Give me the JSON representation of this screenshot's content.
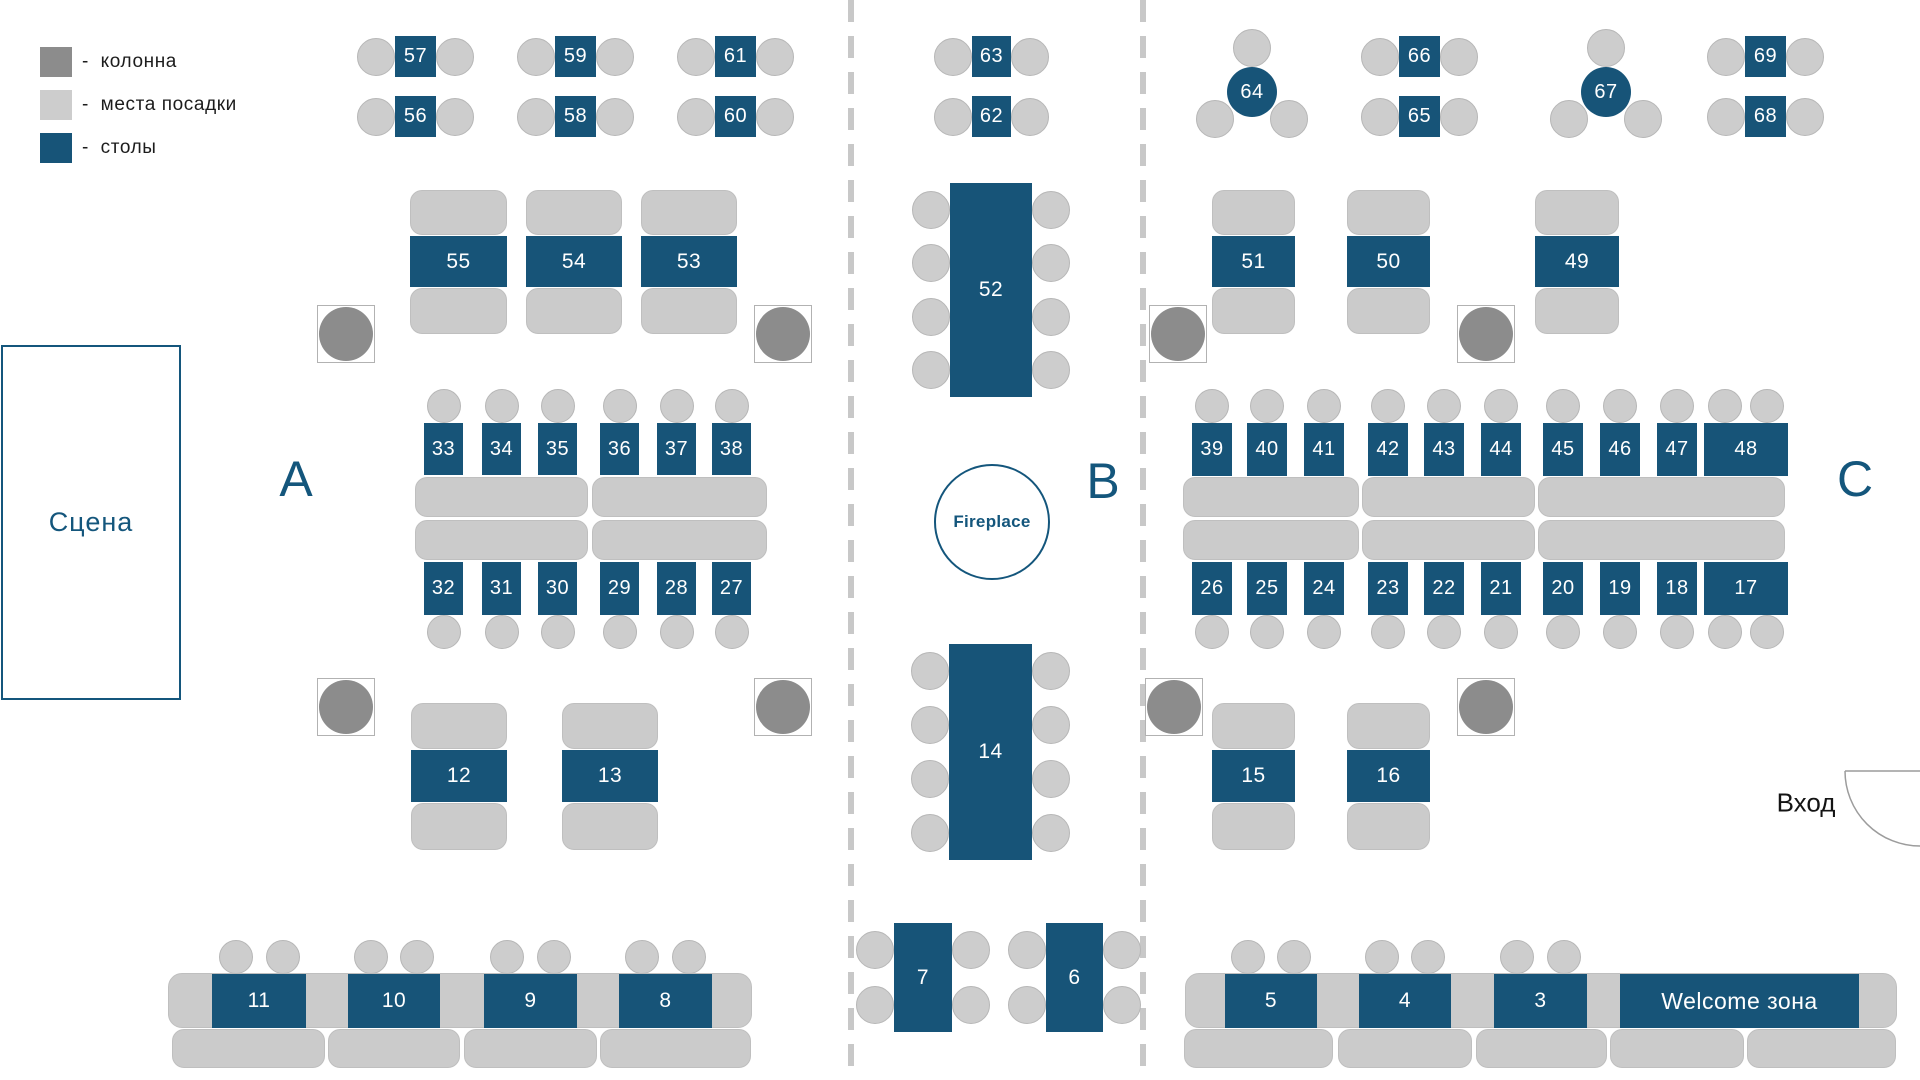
{
  "canvas": {
    "w": 1920,
    "h": 1080
  },
  "colors": {
    "table": "#175478",
    "table_text": "#FFFFFF",
    "seat": "#CDCDCD",
    "seat_stroke": "#B7B7B7",
    "bench": "#CBCBCB",
    "bench_stroke": "#BFBFBF",
    "column": "#8C8C8C",
    "column_box_stroke": "#B2B2B2",
    "divider": "#C8C8C8",
    "blue_text": "#14567C",
    "dark_text": "#1C1C1C",
    "door": "#9C9C9C"
  },
  "legend": {
    "items": [
      {
        "type": "column",
        "label": "-  колонна"
      },
      {
        "type": "seat",
        "label": "-  места посадки"
      },
      {
        "type": "table",
        "label": "-  столы"
      }
    ]
  },
  "labels": {
    "stage": "Сцена",
    "sections": [
      {
        "text": "А",
        "x": 296,
        "y": 479
      },
      {
        "text": "В",
        "x": 1103,
        "y": 481
      },
      {
        "text": "С",
        "x": 1855,
        "y": 479
      }
    ],
    "fireplace": {
      "text": "Fireplace",
      "cx": 992,
      "cy": 522,
      "r": 58
    },
    "entrance": {
      "text": "Вход",
      "x": 1806,
      "y": 803
    }
  },
  "stage": {
    "x": 1,
    "y": 345,
    "w": 180,
    "h": 355
  },
  "door": {
    "wall": "M1845 771 L1920 771",
    "arc": "M1845 771 A75 75 0 0 0 1920 846"
  },
  "dividers": [
    {
      "x": 848
    },
    {
      "x": 1140
    }
  ],
  "columns": [
    {
      "cx": 346,
      "cy": 334
    },
    {
      "cx": 783,
      "cy": 334
    },
    {
      "cx": 1178,
      "cy": 334
    },
    {
      "cx": 1486,
      "cy": 334
    },
    {
      "cx": 346,
      "cy": 707
    },
    {
      "cx": 783,
      "cy": 707
    },
    {
      "cx": 1174,
      "cy": 707
    },
    {
      "cx": 1486,
      "cy": 707
    }
  ],
  "benches": [
    {
      "x": 410,
      "y": 190,
      "w": 97,
      "h": 45
    },
    {
      "x": 526,
      "y": 190,
      "w": 96,
      "h": 45
    },
    {
      "x": 641,
      "y": 190,
      "w": 96,
      "h": 45
    },
    {
      "x": 410,
      "y": 288,
      "w": 97,
      "h": 46
    },
    {
      "x": 526,
      "y": 288,
      "w": 96,
      "h": 46
    },
    {
      "x": 641,
      "y": 288,
      "w": 96,
      "h": 46
    },
    {
      "x": 1212,
      "y": 190,
      "w": 83,
      "h": 45
    },
    {
      "x": 1347,
      "y": 190,
      "w": 83,
      "h": 45
    },
    {
      "x": 1535,
      "y": 190,
      "w": 84,
      "h": 45
    },
    {
      "x": 1212,
      "y": 288,
      "w": 83,
      "h": 46
    },
    {
      "x": 1347,
      "y": 288,
      "w": 83,
      "h": 46
    },
    {
      "x": 1535,
      "y": 288,
      "w": 84,
      "h": 46
    },
    {
      "x": 415,
      "y": 477,
      "w": 173,
      "h": 40
    },
    {
      "x": 592,
      "y": 477,
      "w": 175,
      "h": 40
    },
    {
      "x": 415,
      "y": 520,
      "w": 173,
      "h": 40
    },
    {
      "x": 592,
      "y": 520,
      "w": 175,
      "h": 40
    },
    {
      "x": 1183,
      "y": 477,
      "w": 176,
      "h": 40
    },
    {
      "x": 1362,
      "y": 477,
      "w": 173,
      "h": 40
    },
    {
      "x": 1538,
      "y": 477,
      "w": 247,
      "h": 40
    },
    {
      "x": 1183,
      "y": 520,
      "w": 176,
      "h": 40
    },
    {
      "x": 1362,
      "y": 520,
      "w": 173,
      "h": 40
    },
    {
      "x": 1538,
      "y": 520,
      "w": 247,
      "h": 40
    },
    {
      "x": 411,
      "y": 703,
      "w": 96,
      "h": 46
    },
    {
      "x": 562,
      "y": 703,
      "w": 96,
      "h": 46
    },
    {
      "x": 411,
      "y": 803,
      "w": 96,
      "h": 47
    },
    {
      "x": 562,
      "y": 803,
      "w": 96,
      "h": 47
    },
    {
      "x": 1212,
      "y": 703,
      "w": 83,
      "h": 46
    },
    {
      "x": 1347,
      "y": 703,
      "w": 83,
      "h": 46
    },
    {
      "x": 1212,
      "y": 803,
      "w": 83,
      "h": 47
    },
    {
      "x": 1347,
      "y": 803,
      "w": 83,
      "h": 47
    },
    {
      "x": 168,
      "y": 973,
      "w": 584,
      "h": 55,
      "rad": 14
    },
    {
      "x": 172,
      "y": 1029,
      "w": 153,
      "h": 39
    },
    {
      "x": 328,
      "y": 1029,
      "w": 132,
      "h": 39
    },
    {
      "x": 464,
      "y": 1029,
      "w": 133,
      "h": 39
    },
    {
      "x": 600,
      "y": 1029,
      "w": 151,
      "h": 39
    },
    {
      "x": 1185,
      "y": 973,
      "w": 712,
      "h": 55,
      "rad": 14
    },
    {
      "x": 1184,
      "y": 1029,
      "w": 149,
      "h": 39
    },
    {
      "x": 1338,
      "y": 1029,
      "w": 134,
      "h": 39
    },
    {
      "x": 1476,
      "y": 1029,
      "w": 131,
      "h": 39
    },
    {
      "x": 1610,
      "y": 1029,
      "w": 134,
      "h": 39
    },
    {
      "x": 1747,
      "y": 1029,
      "w": 149,
      "h": 39
    }
  ],
  "tables": [
    {
      "n": "57",
      "x": 395,
      "y": 36,
      "w": 41,
      "h": 41,
      "fs": 20,
      "seats": {
        "left": 1,
        "right": 1
      }
    },
    {
      "n": "56",
      "x": 395,
      "y": 96,
      "w": 41,
      "h": 41,
      "fs": 20,
      "seats": {
        "left": 1,
        "right": 1
      }
    },
    {
      "n": "59",
      "x": 555,
      "y": 36,
      "w": 41,
      "h": 41,
      "fs": 20,
      "seats": {
        "left": 1,
        "right": 1
      }
    },
    {
      "n": "58",
      "x": 555,
      "y": 96,
      "w": 41,
      "h": 41,
      "fs": 20,
      "seats": {
        "left": 1,
        "right": 1
      }
    },
    {
      "n": "61",
      "x": 715,
      "y": 36,
      "w": 41,
      "h": 41,
      "fs": 20,
      "seats": {
        "left": 1,
        "right": 1
      }
    },
    {
      "n": "60",
      "x": 715,
      "y": 96,
      "w": 41,
      "h": 41,
      "fs": 20,
      "seats": {
        "left": 1,
        "right": 1
      }
    },
    {
      "n": "63",
      "x": 972,
      "y": 36,
      "w": 39,
      "h": 41,
      "fs": 20,
      "seats": {
        "left": 1,
        "right": 1
      }
    },
    {
      "n": "62",
      "x": 972,
      "y": 96,
      "w": 39,
      "h": 41,
      "fs": 20,
      "seats": {
        "left": 1,
        "right": 1
      }
    },
    {
      "n": "66",
      "x": 1399,
      "y": 36,
      "w": 41,
      "h": 41,
      "fs": 20,
      "seats": {
        "left": 1,
        "right": 1
      }
    },
    {
      "n": "65",
      "x": 1399,
      "y": 96,
      "w": 41,
      "h": 41,
      "fs": 20,
      "seats": {
        "left": 1,
        "right": 1
      }
    },
    {
      "n": "69",
      "x": 1745,
      "y": 36,
      "w": 41,
      "h": 41,
      "fs": 20,
      "seats": {
        "left": 1,
        "right": 1
      }
    },
    {
      "n": "68",
      "x": 1745,
      "y": 96,
      "w": 41,
      "h": 41,
      "fs": 20,
      "seats": {
        "left": 1,
        "right": 1
      }
    },
    {
      "n": "64",
      "x": 1227,
      "y": 67,
      "w": 50,
      "h": 50,
      "fs": 20,
      "round": true,
      "so": [
        [
          0,
          -44
        ],
        [
          -37,
          27
        ],
        [
          37,
          27
        ]
      ]
    },
    {
      "n": "67",
      "x": 1581,
      "y": 67,
      "w": 50,
      "h": 50,
      "fs": 20,
      "round": true,
      "so": [
        [
          0,
          -44
        ],
        [
          -37,
          27
        ],
        [
          37,
          27
        ]
      ]
    },
    {
      "n": "55",
      "x": 410,
      "y": 236,
      "w": 97,
      "h": 51
    },
    {
      "n": "54",
      "x": 526,
      "y": 236,
      "w": 96,
      "h": 51
    },
    {
      "n": "53",
      "x": 641,
      "y": 236,
      "w": 96,
      "h": 51
    },
    {
      "n": "51",
      "x": 1212,
      "y": 236,
      "w": 83,
      "h": 51
    },
    {
      "n": "50",
      "x": 1347,
      "y": 236,
      "w": 83,
      "h": 51
    },
    {
      "n": "49",
      "x": 1535,
      "y": 236,
      "w": 84,
      "h": 51
    },
    {
      "n": "52",
      "x": 950,
      "y": 183,
      "w": 82,
      "h": 214,
      "seats": {
        "left": 4,
        "right": 4
      }
    },
    {
      "n": "33",
      "x": 424,
      "y": 423,
      "w": 39,
      "h": 52,
      "fs": 20,
      "sr": 17,
      "seats": {
        "top": 1
      }
    },
    {
      "n": "34",
      "x": 482,
      "y": 423,
      "w": 39,
      "h": 52,
      "fs": 20,
      "sr": 17,
      "seats": {
        "top": 1
      }
    },
    {
      "n": "35",
      "x": 538,
      "y": 423,
      "w": 39,
      "h": 52,
      "fs": 20,
      "sr": 17,
      "seats": {
        "top": 1
      }
    },
    {
      "n": "36",
      "x": 600,
      "y": 423,
      "w": 39,
      "h": 52,
      "fs": 20,
      "sr": 17,
      "seats": {
        "top": 1
      }
    },
    {
      "n": "37",
      "x": 657,
      "y": 423,
      "w": 39,
      "h": 52,
      "fs": 20,
      "sr": 17,
      "seats": {
        "top": 1
      }
    },
    {
      "n": "38",
      "x": 712,
      "y": 423,
      "w": 39,
      "h": 52,
      "fs": 20,
      "sr": 17,
      "seats": {
        "top": 1
      }
    },
    {
      "n": "32",
      "x": 424,
      "y": 562,
      "w": 39,
      "h": 53,
      "fs": 20,
      "sr": 17,
      "seats": {
        "bottom": 1
      }
    },
    {
      "n": "31",
      "x": 482,
      "y": 562,
      "w": 39,
      "h": 53,
      "fs": 20,
      "sr": 17,
      "seats": {
        "bottom": 1
      }
    },
    {
      "n": "30",
      "x": 538,
      "y": 562,
      "w": 39,
      "h": 53,
      "fs": 20,
      "sr": 17,
      "seats": {
        "bottom": 1
      }
    },
    {
      "n": "29",
      "x": 600,
      "y": 562,
      "w": 39,
      "h": 53,
      "fs": 20,
      "sr": 17,
      "seats": {
        "bottom": 1
      }
    },
    {
      "n": "28",
      "x": 657,
      "y": 562,
      "w": 39,
      "h": 53,
      "fs": 20,
      "sr": 17,
      "seats": {
        "bottom": 1
      }
    },
    {
      "n": "27",
      "x": 712,
      "y": 562,
      "w": 39,
      "h": 53,
      "fs": 20,
      "sr": 17,
      "seats": {
        "bottom": 1
      }
    },
    {
      "n": "39",
      "x": 1192,
      "y": 423,
      "w": 40,
      "h": 53,
      "fs": 20,
      "sr": 17,
      "seats": {
        "top": 1
      }
    },
    {
      "n": "40",
      "x": 1247,
      "y": 423,
      "w": 40,
      "h": 53,
      "fs": 20,
      "sr": 17,
      "seats": {
        "top": 1
      }
    },
    {
      "n": "41",
      "x": 1304,
      "y": 423,
      "w": 40,
      "h": 53,
      "fs": 20,
      "sr": 17,
      "seats": {
        "top": 1
      }
    },
    {
      "n": "42",
      "x": 1368,
      "y": 423,
      "w": 40,
      "h": 53,
      "fs": 20,
      "sr": 17,
      "seats": {
        "top": 1
      }
    },
    {
      "n": "43",
      "x": 1424,
      "y": 423,
      "w": 40,
      "h": 53,
      "fs": 20,
      "sr": 17,
      "seats": {
        "top": 1
      }
    },
    {
      "n": "44",
      "x": 1481,
      "y": 423,
      "w": 40,
      "h": 53,
      "fs": 20,
      "sr": 17,
      "seats": {
        "top": 1
      }
    },
    {
      "n": "45",
      "x": 1543,
      "y": 423,
      "w": 40,
      "h": 53,
      "fs": 20,
      "sr": 17,
      "seats": {
        "top": 1
      }
    },
    {
      "n": "46",
      "x": 1600,
      "y": 423,
      "w": 40,
      "h": 53,
      "fs": 20,
      "sr": 17,
      "seats": {
        "top": 1
      }
    },
    {
      "n": "47",
      "x": 1657,
      "y": 423,
      "w": 40,
      "h": 53,
      "fs": 20,
      "sr": 17,
      "seats": {
        "top": 1
      }
    },
    {
      "n": "48",
      "x": 1704,
      "y": 423,
      "w": 84,
      "h": 53,
      "fs": 20,
      "sr": 17,
      "seats": {
        "top": 2
      }
    },
    {
      "n": "26",
      "x": 1192,
      "y": 562,
      "w": 40,
      "h": 53,
      "fs": 20,
      "sr": 17,
      "seats": {
        "bottom": 1
      }
    },
    {
      "n": "25",
      "x": 1247,
      "y": 562,
      "w": 40,
      "h": 53,
      "fs": 20,
      "sr": 17,
      "seats": {
        "bottom": 1
      }
    },
    {
      "n": "24",
      "x": 1304,
      "y": 562,
      "w": 40,
      "h": 53,
      "fs": 20,
      "sr": 17,
      "seats": {
        "bottom": 1
      }
    },
    {
      "n": "23",
      "x": 1368,
      "y": 562,
      "w": 40,
      "h": 53,
      "fs": 20,
      "sr": 17,
      "seats": {
        "bottom": 1
      }
    },
    {
      "n": "22",
      "x": 1424,
      "y": 562,
      "w": 40,
      "h": 53,
      "fs": 20,
      "sr": 17,
      "seats": {
        "bottom": 1
      }
    },
    {
      "n": "21",
      "x": 1481,
      "y": 562,
      "w": 40,
      "h": 53,
      "fs": 20,
      "sr": 17,
      "seats": {
        "bottom": 1
      }
    },
    {
      "n": "20",
      "x": 1543,
      "y": 562,
      "w": 40,
      "h": 53,
      "fs": 20,
      "sr": 17,
      "seats": {
        "bottom": 1
      }
    },
    {
      "n": "19",
      "x": 1600,
      "y": 562,
      "w": 40,
      "h": 53,
      "fs": 20,
      "sr": 17,
      "seats": {
        "bottom": 1
      }
    },
    {
      "n": "18",
      "x": 1657,
      "y": 562,
      "w": 40,
      "h": 53,
      "fs": 20,
      "sr": 17,
      "seats": {
        "bottom": 1
      }
    },
    {
      "n": "17",
      "x": 1704,
      "y": 562,
      "w": 84,
      "h": 53,
      "fs": 20,
      "sr": 17,
      "seats": {
        "bottom": 2
      }
    },
    {
      "n": "12",
      "x": 411,
      "y": 750,
      "w": 96,
      "h": 52
    },
    {
      "n": "13",
      "x": 562,
      "y": 750,
      "w": 96,
      "h": 52
    },
    {
      "n": "15",
      "x": 1212,
      "y": 750,
      "w": 83,
      "h": 52
    },
    {
      "n": "16",
      "x": 1347,
      "y": 750,
      "w": 83,
      "h": 52
    },
    {
      "n": "14",
      "x": 949,
      "y": 644,
      "w": 83,
      "h": 216,
      "seats": {
        "left": 4,
        "right": 4
      }
    },
    {
      "n": "7",
      "x": 894,
      "y": 923,
      "w": 58,
      "h": 109,
      "seats": {
        "left": 2,
        "right": 2
      }
    },
    {
      "n": "6",
      "x": 1046,
      "y": 923,
      "w": 57,
      "h": 109,
      "seats": {
        "left": 2,
        "right": 2
      }
    },
    {
      "n": "11",
      "x": 212,
      "y": 974,
      "w": 94,
      "h": 54,
      "sr": 17,
      "seats": {
        "top": 2
      }
    },
    {
      "n": "10",
      "x": 348,
      "y": 974,
      "w": 92,
      "h": 54,
      "sr": 17,
      "seats": {
        "top": 2
      }
    },
    {
      "n": "9",
      "x": 484,
      "y": 974,
      "w": 93,
      "h": 54,
      "sr": 17,
      "seats": {
        "top": 2
      }
    },
    {
      "n": "8",
      "x": 619,
      "y": 974,
      "w": 93,
      "h": 54,
      "sr": 17,
      "seats": {
        "top": 2
      }
    },
    {
      "n": "5",
      "x": 1225,
      "y": 974,
      "w": 92,
      "h": 54,
      "sr": 17,
      "seats": {
        "top": 2
      }
    },
    {
      "n": "4",
      "x": 1359,
      "y": 974,
      "w": 92,
      "h": 54,
      "sr": 17,
      "seats": {
        "top": 2
      }
    },
    {
      "n": "3",
      "x": 1494,
      "y": 974,
      "w": 93,
      "h": 54,
      "sr": 17,
      "seats": {
        "top": 2
      }
    },
    {
      "n": "Welcome зона",
      "x": 1620,
      "y": 974,
      "w": 239,
      "h": 54,
      "fs": 23
    }
  ]
}
